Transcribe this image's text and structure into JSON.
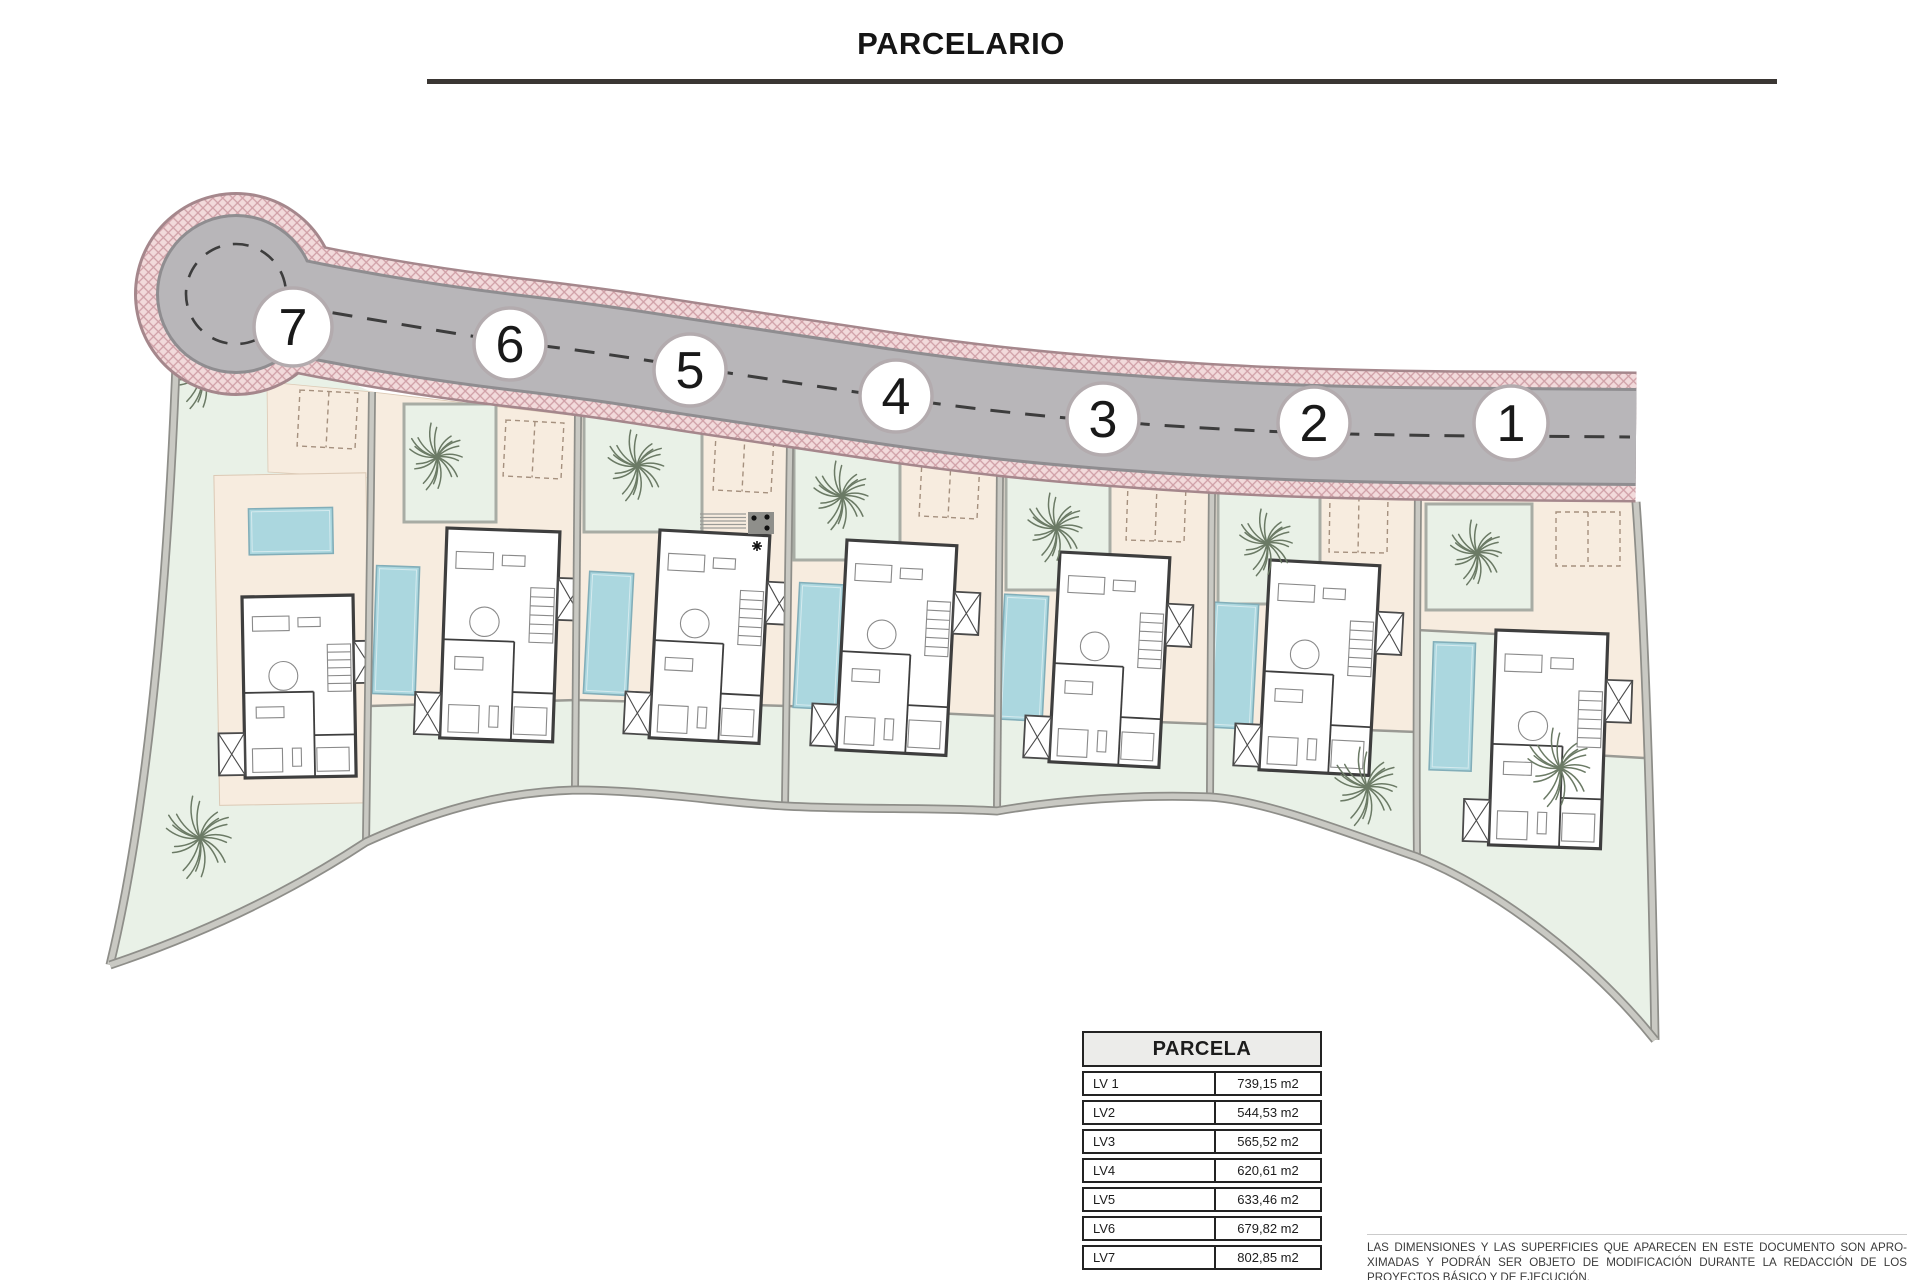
{
  "title": "PARCELARIO",
  "table": {
    "header": "PARCELA",
    "rows": [
      {
        "label": "LV 1",
        "value": "739,15 m2"
      },
      {
        "label": "LV2",
        "value": "544,53 m2"
      },
      {
        "label": "LV3",
        "value": "565,52 m2"
      },
      {
        "label": "LV4",
        "value": "620,61 m2"
      },
      {
        "label": "LV5",
        "value": "633,46 m2"
      },
      {
        "label": "LV6",
        "value": "679,82 m2"
      },
      {
        "label": "LV7",
        "value": "802,85 m2"
      }
    ]
  },
  "disclaimer": {
    "lines": [
      "LAS DIMENSIONES Y LAS SUPERFICIES QUE APARECEN EN ESTE DOCUMENTO SON APRO-",
      "XIMADAS Y PODRÁN SER OBJETO DE MODIFICACIÓN DURANTE LA REDACCIÓN DE LOS",
      "PROYECTOS BÁSICO Y DE EJECUCIÓN."
    ]
  },
  "colors": {
    "mint": "#e9f1e7",
    "mintFrame": "#a8aca4",
    "beige": "#f7ecdf",
    "beigeEdge": "#dcc9b5",
    "terraceWall": "#9a9a94",
    "pool": "#abd7df",
    "poolEdge": "#82aeb9",
    "poolInner": "#d5eaee",
    "roadGray": "#b8b6b9",
    "roadEdge": "#8f8d90",
    "pinkBase": "#f2dadb",
    "pinkLine": "#cf9fa6",
    "pinkOutline": "#a5878c",
    "wall": "#3e3e3e",
    "furniture": "#8a8a8a",
    "divDark": "#8e8e89",
    "divLight": "#c9c9c3",
    "palm": "#6b7a65",
    "dash": "#3d3d3d",
    "circleStroke": "#b3abae",
    "circleText": "#191919",
    "parking": "#a5907e"
  },
  "plan": {
    "road": {
      "centerline": "M236,294 C330,316 420,331 510,342 C580,350 620,356 690,367 C760,378 830,388 896,398 C980,410 1040,416 1103,421 C1180,427 1250,431 1314,433 C1380,435 1450,436 1511,436 L1636,437",
      "dashline": "M298,307 C400,324 450,333 510,342 C580,350 620,356 690,367 C760,378 830,388 896,398 C980,410 1040,416 1103,421 C1180,427 1250,431 1314,433 C1380,435 1450,436 1511,436 L1630,437",
      "culdesac": {
        "x": 236,
        "y": 294,
        "rOutline": 102,
        "rPink": 99,
        "rEdge": 80,
        "rGray": 77,
        "rDash": 50
      },
      "grayW": 92,
      "edgeW": 98,
      "pinkW": 126,
      "pinkOutW": 131
    },
    "outerEdge": "M178,310 C170,560 150,800 110,965",
    "rightEdge": "M1636,502 C1646,640 1652,860 1655,1040",
    "boundary": "M110,965 C205,933 290,892 366,842 C445,806 510,792 575,790 C650,790 725,803 785,806 C860,810 930,807 997,811 C1060,800 1140,794 1210,797 C1262,800 1340,830 1417,857 C1500,890 1595,965 1655,1040",
    "dividers": [
      "M372,392 C370,560 368,760 366,842",
      "M578,416 C577,560 576,700 575,790",
      "M790,445 C788,580 786,720 785,806",
      "M1000,470 C998,600 997,730 997,811",
      "M1212,487 C1211,600 1210,720 1210,797",
      "M1418,492 C1417,620 1416,760 1417,857"
    ],
    "plots": [
      {
        "id": 7,
        "outline": "M178,310 L372,392 C370,560 368,760 366,842 C290,892 205,933 110,965 C150,800 170,560 178,310 Z",
        "entry": "M267,382 L372,392 L370,478 L268,472 Z",
        "circle": {
          "x": 293,
          "y": 327,
          "r": 39,
          "label": "7"
        },
        "villa": {
          "x": 242,
          "y": 597,
          "rot": -1,
          "w": 111,
          "h": 181,
          "pool": {
            "x": 8,
            "y": -88,
            "w": 84,
            "h": 46
          },
          "patio": {
            "x": -26,
            "y": -122,
            "w": 152,
            "h": 330
          }
        },
        "parking": {
          "x": 300,
          "y": 390,
          "w": 58,
          "h": 56,
          "rot": 3
        },
        "palms": [
          {
            "x": 202,
            "y": 372,
            "r": 38
          },
          {
            "x": 200,
            "y": 838,
            "r": 42
          }
        ]
      },
      {
        "id": 6,
        "outline": "M372,392 L578,416 C577,560 576,700 575,790 C510,792 445,806 385,838 L366,842 C368,760 370,560 372,392 Z",
        "beige": "M372,392 L578,416 L577,700 L370,706 Z",
        "beigeLine": "M370,706 L577,700",
        "mintSquare": {
          "x": 404,
          "y": 404,
          "w": 92,
          "h": 118
        },
        "circle": {
          "x": 510,
          "y": 344,
          "r": 36,
          "label": "6"
        },
        "villa": {
          "x": 447,
          "y": 528,
          "rot": 2,
          "w": 113,
          "h": 210,
          "pool": {
            "x": -69,
            "y": 40,
            "w": 43,
            "h": 128
          }
        },
        "parking": {
          "x": 506,
          "y": 420,
          "w": 58,
          "h": 56,
          "rot": 3
        },
        "palms": [
          {
            "x": 437,
            "y": 457,
            "r": 34
          }
        ]
      },
      {
        "id": 5,
        "outline": "M578,416 L790,445 C788,580 786,720 785,806 C725,803 650,790 575,790 C576,700 577,560 578,416 Z",
        "beige": "M578,416 L790,445 L787,706 L577,700 Z",
        "beigeLine": "M577,700 L787,706",
        "mintSquare": {
          "x": 584,
          "y": 414,
          "w": 118,
          "h": 118
        },
        "circle": {
          "x": 690,
          "y": 370,
          "r": 36,
          "label": "5"
        },
        "villa": {
          "x": 660,
          "y": 530,
          "rot": 3,
          "w": 110,
          "h": 208,
          "pool": {
            "x": -68,
            "y": 45,
            "w": 44,
            "h": 122
          }
        },
        "parking": {
          "x": 716,
          "y": 434,
          "w": 58,
          "h": 56,
          "rot": 3
        },
        "palms": [
          {
            "x": 637,
            "y": 466,
            "r": 36
          }
        ],
        "steps": {
          "x": 700,
          "y": 514,
          "w": 46,
          "h": 14
        },
        "utility": {
          "x": 748,
          "y": 512,
          "w": 26,
          "h": 22,
          "dots": [
            {
              "x": 754,
              "y": 518
            },
            {
              "x": 767,
              "y": 517
            },
            {
              "x": 767,
              "y": 528
            }
          ],
          "star": {
            "x": 757,
            "y": 546
          }
        }
      },
      {
        "id": 4,
        "outline": "M790,445 L1000,470 C998,600 997,730 997,811 C930,807 860,810 785,806 C786,720 788,580 790,445 Z",
        "beige": "M790,445 L1000,470 L997,716 L787,706 Z",
        "beigeLine": "M787,706 L997,716",
        "mintSquare": {
          "x": 794,
          "y": 442,
          "w": 106,
          "h": 118
        },
        "circle": {
          "x": 896,
          "y": 396,
          "r": 36,
          "label": "4"
        },
        "villa": {
          "x": 847,
          "y": 540,
          "rot": 3,
          "w": 110,
          "h": 210,
          "pool": {
            "x": -45,
            "y": 45,
            "w": 44,
            "h": 125
          }
        },
        "parking": {
          "x": 922,
          "y": 460,
          "w": 58,
          "h": 56,
          "rot": 3
        },
        "palms": [
          {
            "x": 842,
            "y": 496,
            "r": 35
          }
        ]
      },
      {
        "id": 3,
        "outline": "M1000,470 L1212,487 C1211,600 1210,720 1210,797 C1140,794 1060,800 997,811 C997,730 998,600 1000,470 Z",
        "beige": "M1000,470 L1212,487 L1210,724 L997,716 Z",
        "beigeLine": "M997,716 L1210,724",
        "mintSquare": {
          "x": 1006,
          "y": 474,
          "w": 104,
          "h": 116
        },
        "circle": {
          "x": 1103,
          "y": 419,
          "r": 36,
          "label": "3"
        },
        "villa": {
          "x": 1060,
          "y": 552,
          "rot": 3,
          "w": 110,
          "h": 210,
          "pool": {
            "x": -53,
            "y": 45,
            "w": 44,
            "h": 125
          }
        },
        "parking": {
          "x": 1128,
          "y": 484,
          "w": 58,
          "h": 56,
          "rot": 2
        },
        "palms": [
          {
            "x": 1056,
            "y": 528,
            "r": 35
          }
        ]
      },
      {
        "id": 2,
        "outline": "M1212,487 L1418,492 C1417,620 1416,760 1417,857 C1340,830 1262,800 1210,797 C1210,720 1211,600 1212,487 Z",
        "beige": "M1212,487 L1418,492 L1417,732 L1210,724 Z",
        "beigeLine": "M1210,724 L1417,732",
        "mintSquare": {
          "x": 1218,
          "y": 490,
          "w": 102,
          "h": 114
        },
        "circle": {
          "x": 1314,
          "y": 423,
          "r": 36,
          "label": "2"
        },
        "villa": {
          "x": 1270,
          "y": 560,
          "rot": 3,
          "w": 110,
          "h": 210,
          "pool": {
            "x": -53,
            "y": 45,
            "w": 44,
            "h": 125
          }
        },
        "parking": {
          "x": 1330,
          "y": 496,
          "w": 58,
          "h": 56,
          "rot": 1
        },
        "palms": [
          {
            "x": 1267,
            "y": 543,
            "r": 34
          },
          {
            "x": 1367,
            "y": 787,
            "r": 40
          }
        ]
      },
      {
        "id": 1,
        "outline": "M1418,492 L1636,502 C1646,640 1652,860 1655,1040 C1595,965 1500,890 1417,857 C1416,760 1417,620 1418,492 Z",
        "beige": "M1418,492 L1636,502 L1644,758 L1540,752 L1536,636 L1417,630 Z",
        "beigeLine": "M1417,630 L1536,636 L1540,752 L1644,758",
        "mintSquare": {
          "x": 1426,
          "y": 504,
          "w": 106,
          "h": 106
        },
        "circle": {
          "x": 1511,
          "y": 423,
          "r": 37,
          "label": "1"
        },
        "villa": {
          "x": 1496,
          "y": 630,
          "rot": 2,
          "w": 112,
          "h": 215,
          "pool": {
            "x": -62,
            "y": 14,
            "w": 42,
            "h": 128
          }
        },
        "parking": {
          "x": 1556,
          "y": 512,
          "w": 64,
          "h": 54,
          "rot": 0
        },
        "palms": [
          {
            "x": 1477,
            "y": 553,
            "r": 33
          },
          {
            "x": 1560,
            "y": 768,
            "r": 40
          }
        ]
      }
    ]
  }
}
